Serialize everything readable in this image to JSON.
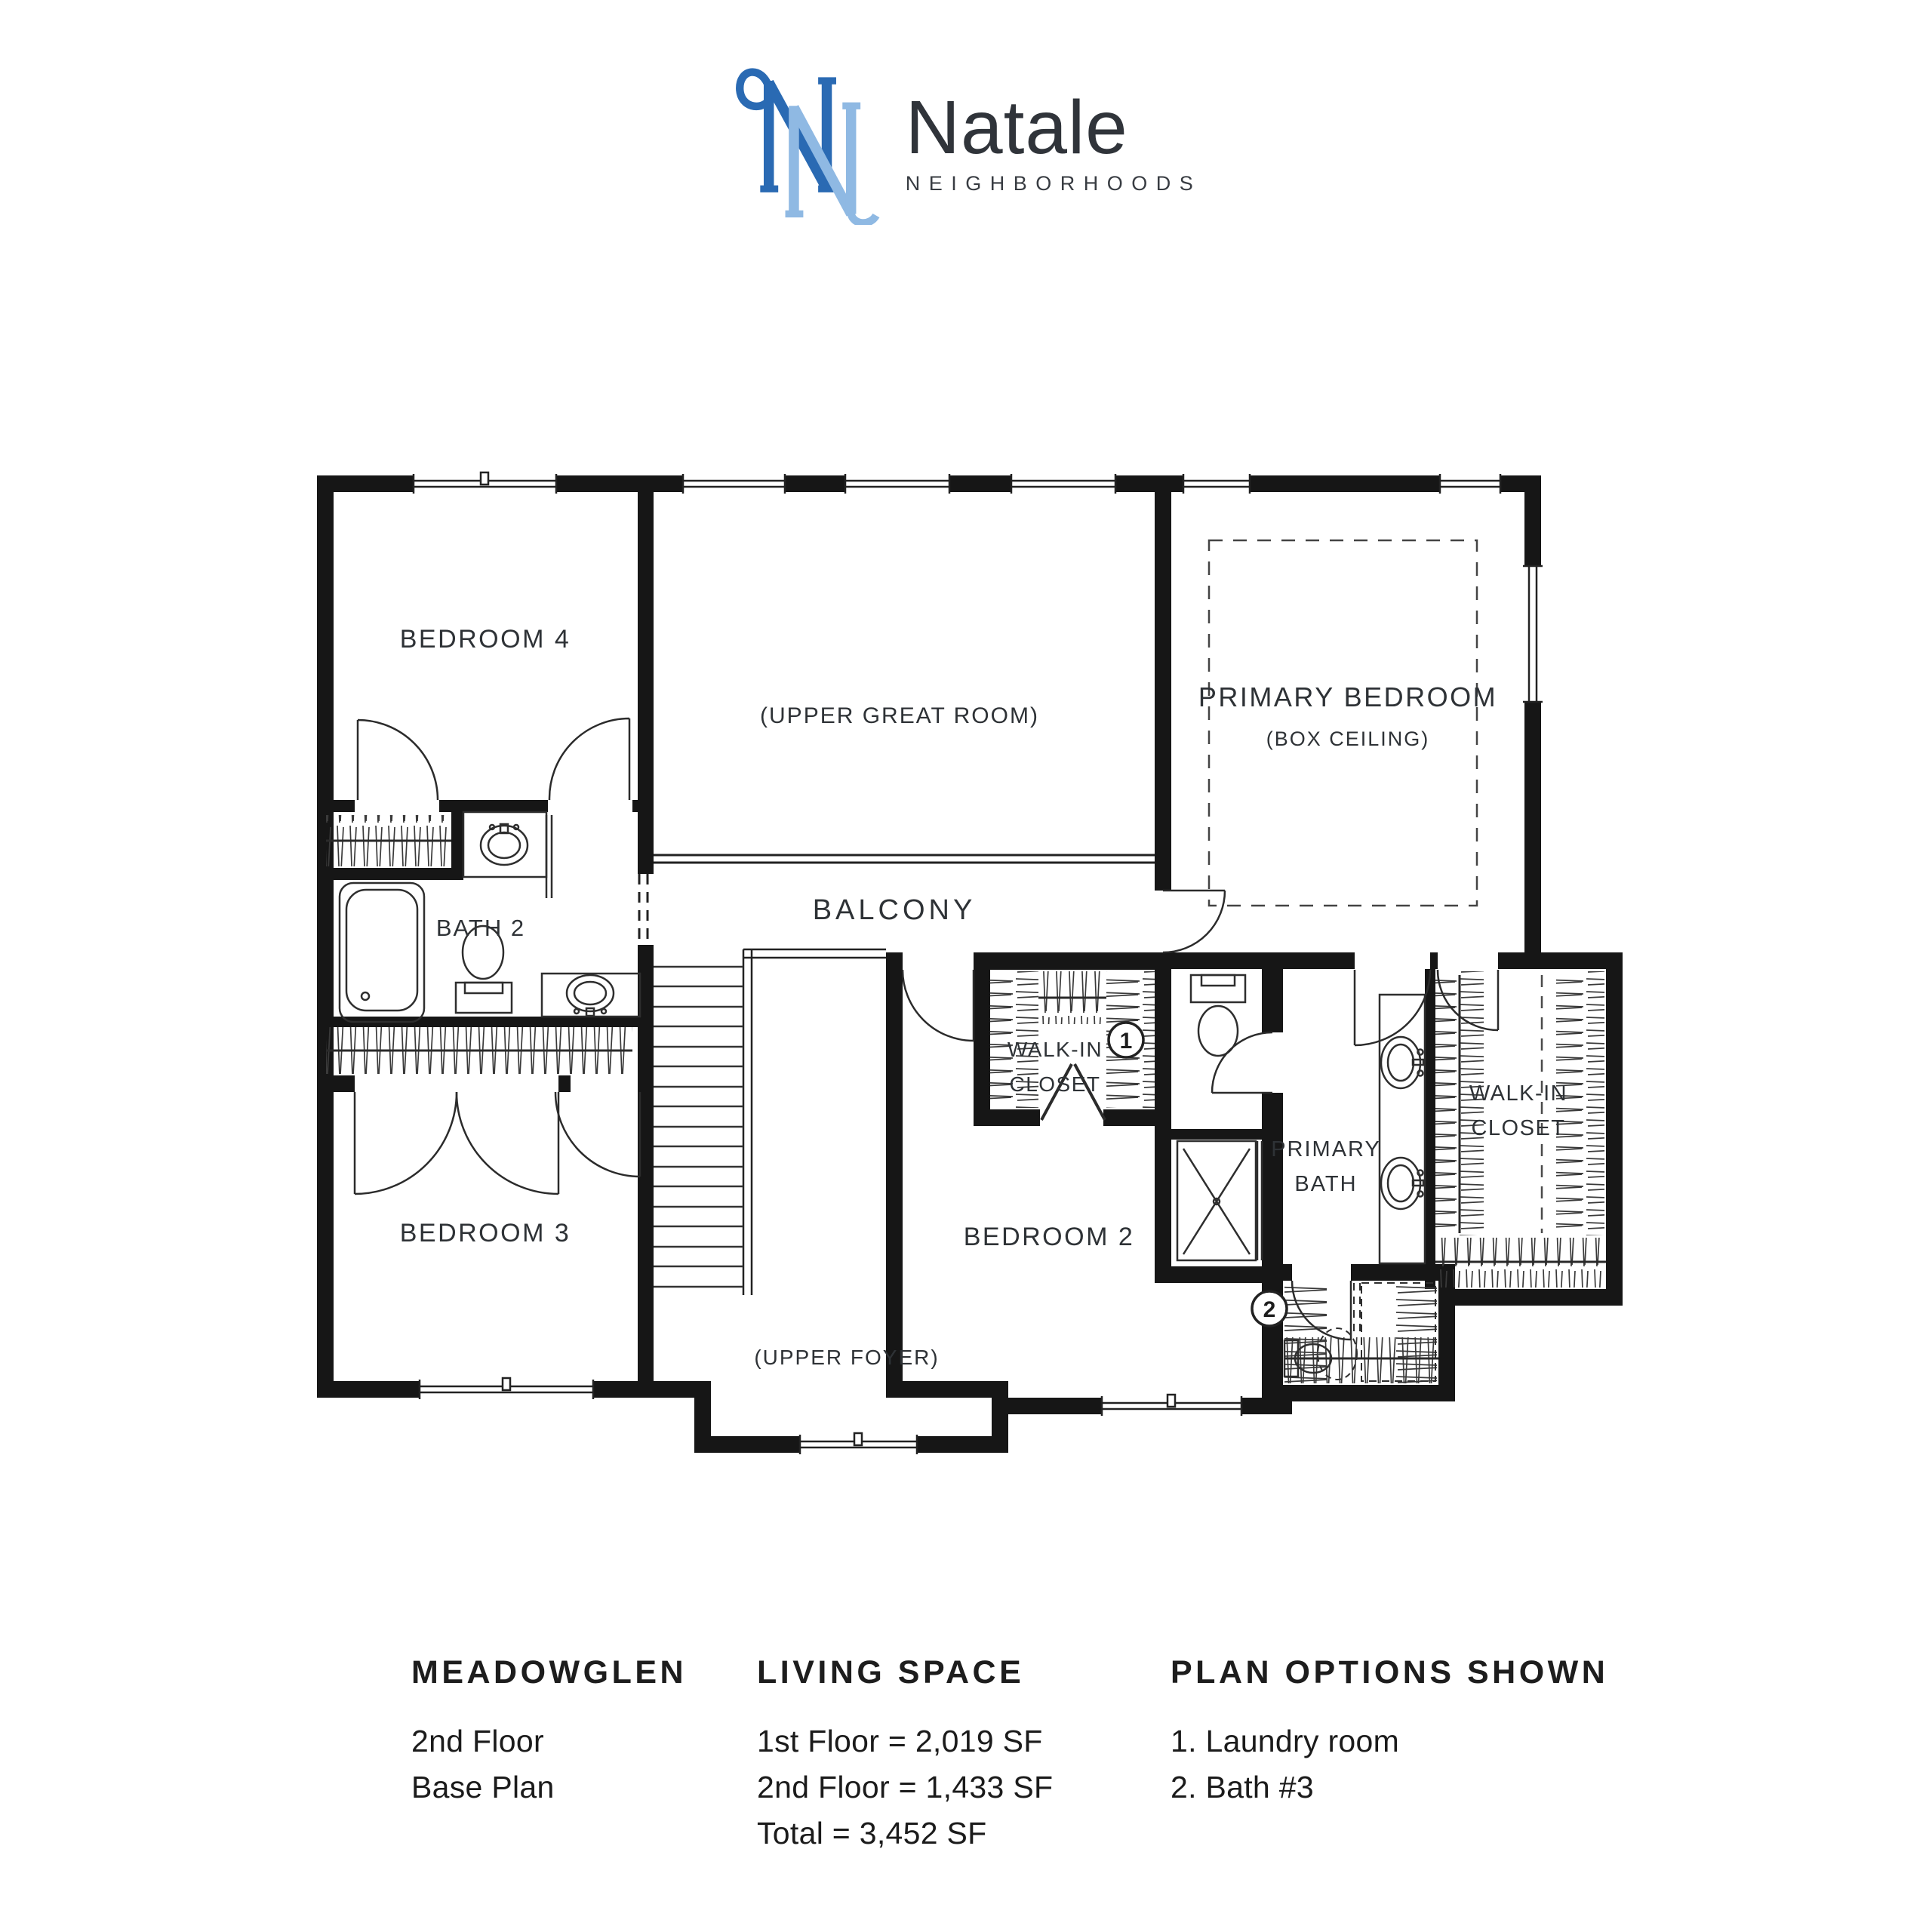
{
  "logo": {
    "monogram": "N",
    "brand": "Natale",
    "tagline": "NEIGHBORHOODS",
    "colors": {
      "dark_blue": "#2a6ab3",
      "light_blue": "#8fb9e3",
      "ink": "#30343a"
    }
  },
  "plan": {
    "rooms": {
      "bedroom4": "BEDROOM 4",
      "upper_great_room": "(UPPER GREAT ROOM)",
      "primary_bedroom": "PRIMARY BEDROOM",
      "box_ceiling": "(BOX CEILING)",
      "bath2": "BATH 2",
      "balcony": "BALCONY",
      "wic1_line1": "WALK-IN",
      "wic1_line2": "CLOSET",
      "primary_bath_line1": "PRIMARY",
      "primary_bath_line2": "BATH",
      "wic2_line1": "WALK-IN",
      "wic2_line2": "CLOSET",
      "bedroom3": "BEDROOM 3",
      "bedroom2": "BEDROOM 2",
      "upper_foyer": "(UPPER FOYER)"
    },
    "markers": {
      "m1": "1",
      "m2": "2"
    }
  },
  "footer": {
    "plan_name": {
      "title": "MEADOWGLEN",
      "lines": [
        "2nd Floor",
        "Base Plan"
      ]
    },
    "living_space": {
      "title": "LIVING SPACE",
      "lines": [
        "1st Floor = 2,019 SF",
        "2nd Floor = 1,433 SF",
        "Total = 3,452 SF"
      ]
    },
    "plan_options": {
      "title": "PLAN OPTIONS SHOWN",
      "lines": [
        "1. Laundry room",
        "2. Bath #3"
      ]
    }
  }
}
